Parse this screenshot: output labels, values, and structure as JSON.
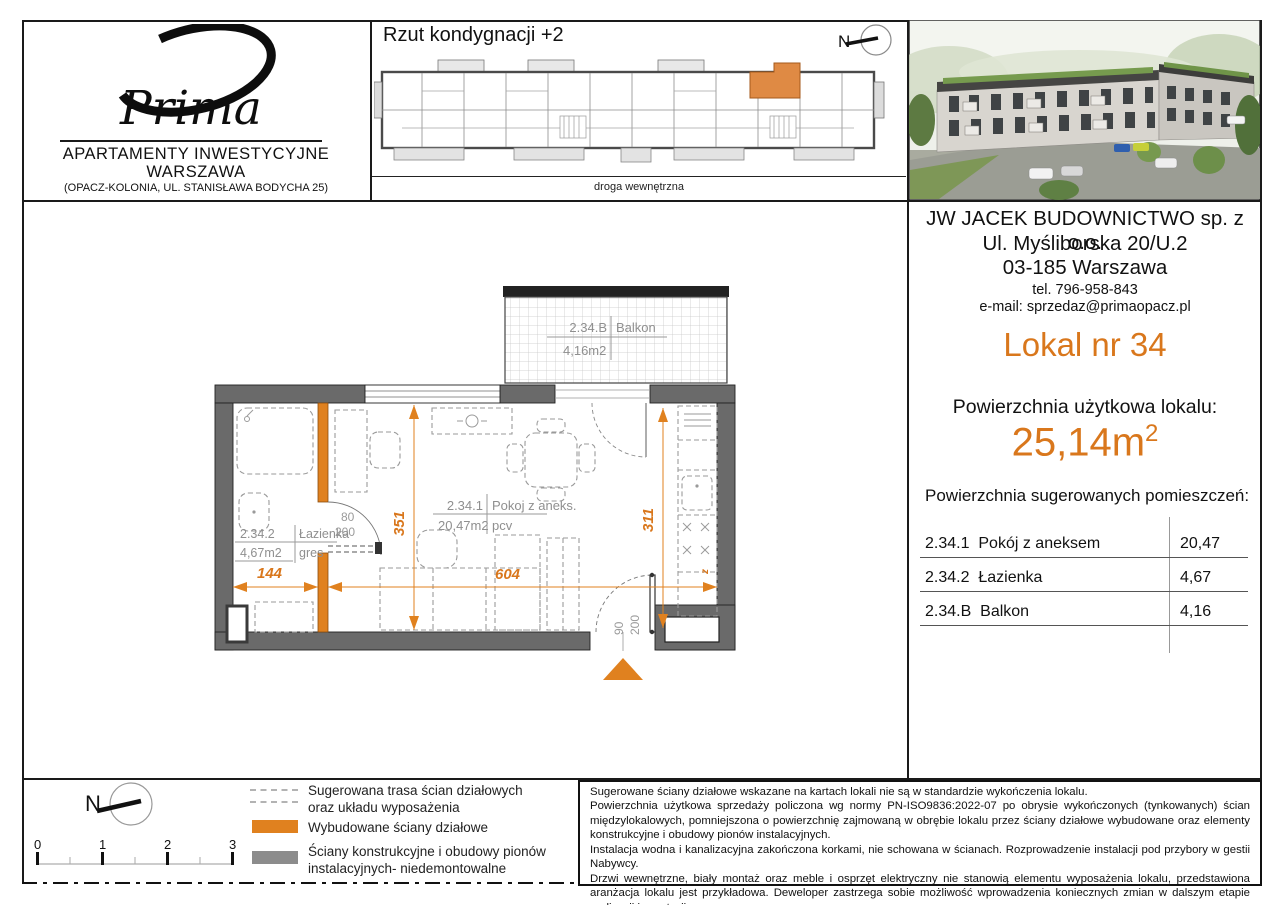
{
  "logo": {
    "brand": "Prima",
    "title1": "APARTAMENTY INWESTYCYJNE",
    "title2": "WARSZAWA",
    "subtitle": "(OPACZ-KOLONIA, UL. STANISŁAWA BODYCHA 25)"
  },
  "overview": {
    "title": "Rzut kondygnacji +2",
    "compass": "N",
    "road": "droga wewnętrzna"
  },
  "company": {
    "name": "JW JACEK BUDOWNICTWO sp. z o.o.",
    "street": "Ul. Myśliborska 20/U.2",
    "city": "03-185 Warszawa",
    "phone": "tel. 796-958-843",
    "email": "e-mail: sprzedaz@primaopacz.pl"
  },
  "unit": {
    "title": "Lokal nr 34",
    "usable_area_label": "Powierzchnia użytkowa lokalu:",
    "usable_area": "25,14m",
    "usable_area_sup": "2",
    "rooms_header": "Powierzchnia sugerowanych pomieszczeń:",
    "rooms": [
      {
        "code": "2.34.1",
        "name": "Pokój z aneksem",
        "area": "20,47"
      },
      {
        "code": "2.34.2",
        "name": "Łazienka",
        "area": "4,67"
      },
      {
        "code": "2.34.B",
        "name": "Balkon",
        "area": "4,16"
      }
    ]
  },
  "plan": {
    "balcony": {
      "code": "2.34.B",
      "name": "Balkon",
      "area": "4,16m2"
    },
    "room": {
      "code": "2.34.1",
      "name": "Pokoj z aneks.",
      "area": "20,47m2",
      "floor": "pcv"
    },
    "bath": {
      "code": "2.34.2",
      "name": "Łazienka",
      "area": "4,67m2",
      "floor": "gres"
    },
    "dims": {
      "d144": "144",
      "d604": "604",
      "d351": "351",
      "d311": "311",
      "door80": "80",
      "door80h": "200",
      "door90": "90",
      "door90h": "200",
      "z": "z"
    }
  },
  "legend": {
    "compass": "N",
    "scale": [
      "0",
      "1",
      "2",
      "3"
    ],
    "item1a": "Sugerowana trasa ścian działowych",
    "item1b": "oraz układu wyposażenia",
    "item2": "Wybudowane ściany działowe",
    "item3a": "Ściany konstrukcyjne i obudowy pionów",
    "item3b": "instalacyjnych- niedemontowalne"
  },
  "disclaimer": {
    "p1": "Sugerowane ściany działowe wskazane na kartach lokali nie są w standardzie wykończenia lokalu.",
    "p2": "Powierzchnia użytkowa sprzedaży policzona wg normy PN-ISO9836:2022-07 po obrysie wykończonych (tynkowanych) ścian międzylokalowych, pomniejszona o powierzchnię zajmowaną w obrębie lokalu przez ściany działowe wybudowane  oraz elementy konstrukcyjne i obudowy pionów instalacyjnych.",
    "p3": "Instalacja wodna i kanalizacyjna zakończona korkami, nie schowana w ścianach. Rozprowadzenie instalacji pod przybory w gestii Nabywcy.",
    "p4": "Drzwi wewnętrzne, biały montaż oraz meble i osprzęt elektryczny nie stanowią elementu wyposażenia lokalu, przedstawiona aranżacja lokalu jest przykładowa. Deweloper zastrzega sobie możliwość wprowadzenia koniecznych zmian w dalszym etapie realizacji inwestycji."
  },
  "colors": {
    "accent": "#D9771C",
    "wall_dark": "#6A6A6A",
    "wall_orange": "#E0811F",
    "legend_gray": "#8C8C8C"
  }
}
